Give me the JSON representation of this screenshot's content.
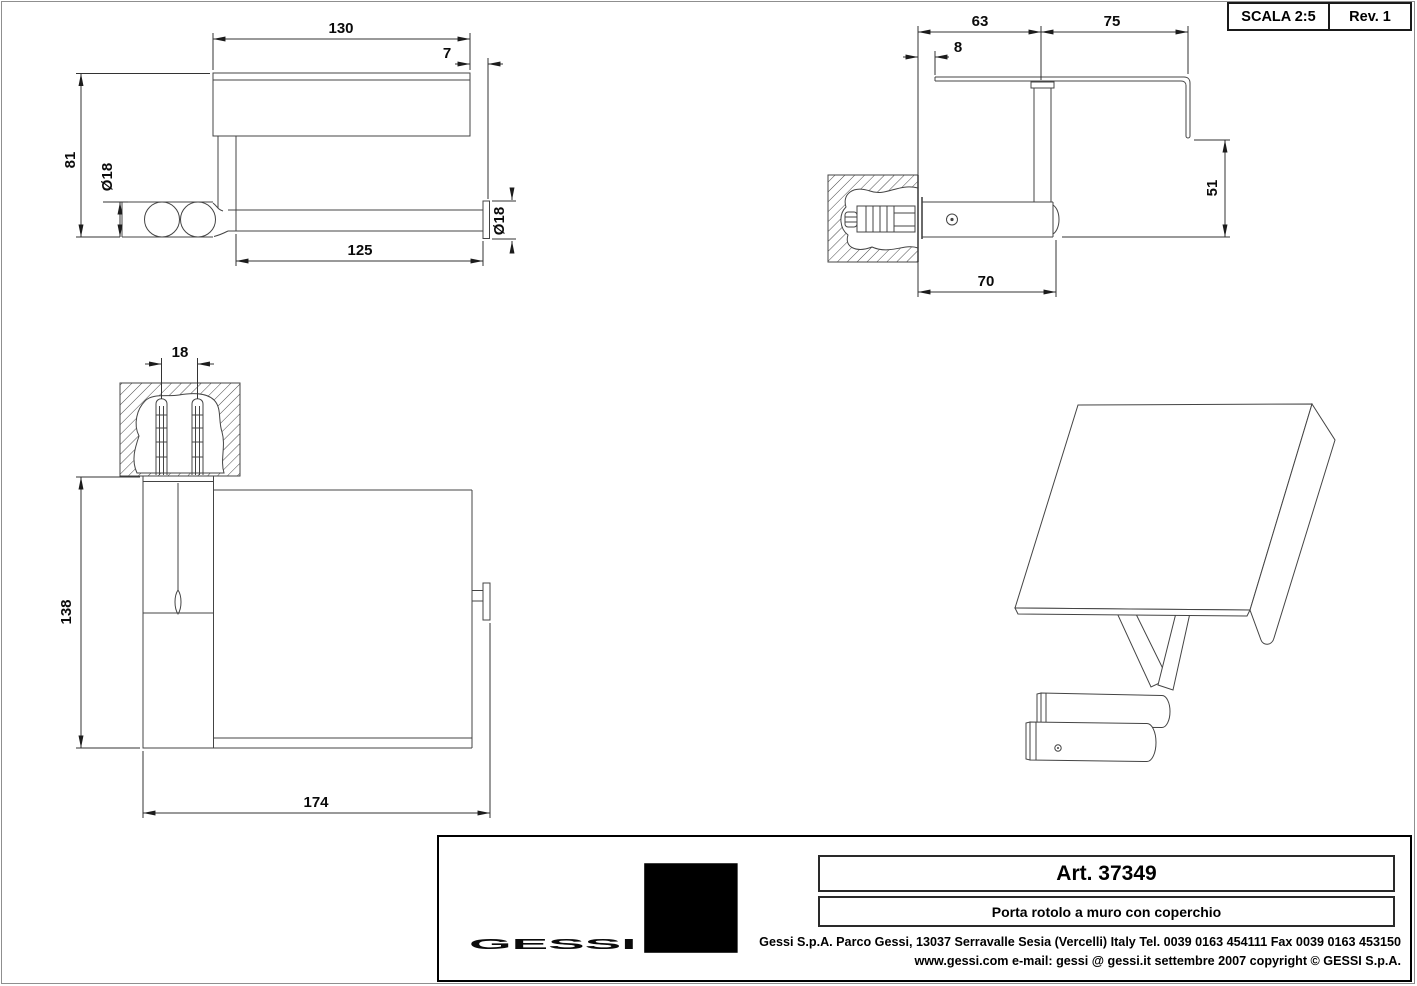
{
  "sheet": {
    "scale": "SCALA 2:5",
    "revision": "Rev. 1"
  },
  "dimensions": {
    "front": {
      "cover_width": "130",
      "lip_offset": "7",
      "height": "81",
      "roller_diameter": "Ø18",
      "roller_length": "125",
      "end_cap_diameter": "Ø18"
    },
    "section": {
      "cover_back": "63",
      "cover_front": "75",
      "wall_gap": "8",
      "lip_drop": "51",
      "arm_length": "70"
    },
    "plan": {
      "anchor_spacing": "18",
      "depth": "138",
      "overall_width": "174"
    }
  },
  "title_block": {
    "brand": "GESSI",
    "article": "Art. 37349",
    "description": "Porta rotolo a muro con coperchio",
    "address": "Gessi S.p.A. Parco Gessi, 13037 Serravalle Sesia (Vercelli) Italy Tel. 0039 0163 454111 Fax 0039 0163 453150",
    "contact": "www.gessi.com e-mail: gessi @ gessi.it settembre 2007 copyright © GESSI S.p.A."
  }
}
